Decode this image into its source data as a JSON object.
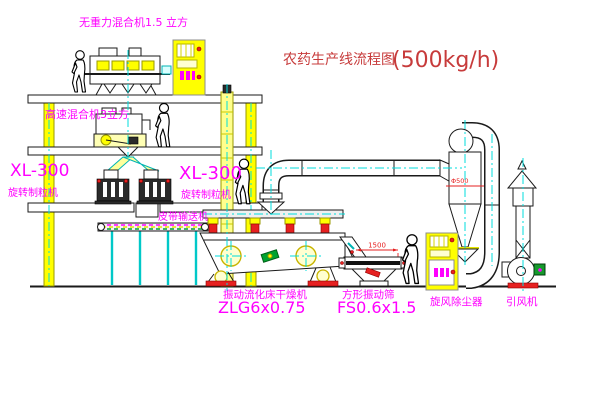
{
  "title": {
    "name": "农药生产线流程图",
    "capacity": "(500kg/h)"
  },
  "labels": {
    "gravity_mixer": "无重力混合机1.5 立方",
    "high_speed_mixer": "高速混合机3立方",
    "granulator_left_model": "XL-300",
    "granulator_left_name": "旋转制粒机",
    "granulator_right_model": "XL-300",
    "granulator_right_name": "旋转制粒机",
    "belt_conveyor": "皮带输送机",
    "dryer_name": "振动流化床干燥机",
    "dryer_model": "ZLG6x0.75",
    "sieve_name": "方形振动筛",
    "sieve_model": "FS0.6x1.5",
    "cyclone": "旋风除尘器",
    "fan": "引风机"
  },
  "dimensions": {
    "sieve_length": "1500",
    "sieve_height": "350",
    "cyclone_note": "Φ500"
  },
  "colors": {
    "magenta": "#ff00ff",
    "title-red": "#c73b3b",
    "yellow": "#ffff00",
    "cyan": "#00dcdc",
    "red": "#e62020",
    "green": "#00a32e",
    "line": "#1a1a1a"
  }
}
